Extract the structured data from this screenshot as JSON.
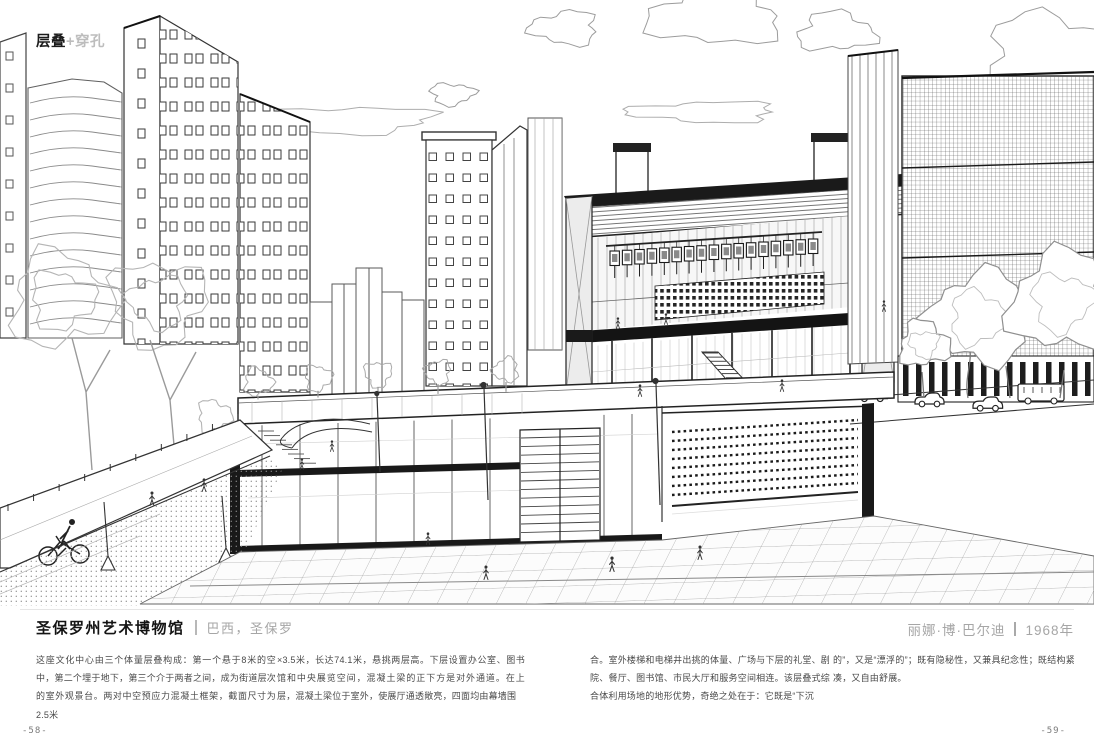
{
  "header": {
    "technique_bold": "层叠",
    "technique_light": "+穿孔"
  },
  "project": {
    "title": "圣保罗州艺术博物馆",
    "location": "巴西，圣保罗",
    "architect": "丽娜·博·巴尔迪",
    "year": "1968年"
  },
  "body_columns": [
    "这座文化中心由三个体量层叠构成：第一个悬于8米的空中，第二个埋于地下，第三个介于两者之间，成为街道层次的室外观景台。两对中空预应力混凝土框架，截面尺寸为2.5米",
    "×3.5米，长达74.1米，悬挑两层高。下层设置办公室、图书馆和中央展览空间，混凝土梁的正下方是对外通道。在上层，混凝土梁位于室外，使展厅通透敞亮，四面均由幕墙围",
    "合。室外楼梯和电梯井出挑的体量、广场与下层的礼堂、剧院、餐厅、图书馆、市民大厅和服务空间相连。该层叠式综合体利用场地的地形优势，奇绝之处在于：它既是“下沉",
    "的”，又是“漂浮的”；既有隐秘性，又兼具纪念性；既结构紧凑，又自由舒展。"
  ],
  "page_numbers": {
    "left": "-58-",
    "right": "-59-"
  },
  "colors": {
    "ink": "#222222",
    "muted_gray": "#a6a6a6",
    "body_text": "#4a4a4a"
  }
}
